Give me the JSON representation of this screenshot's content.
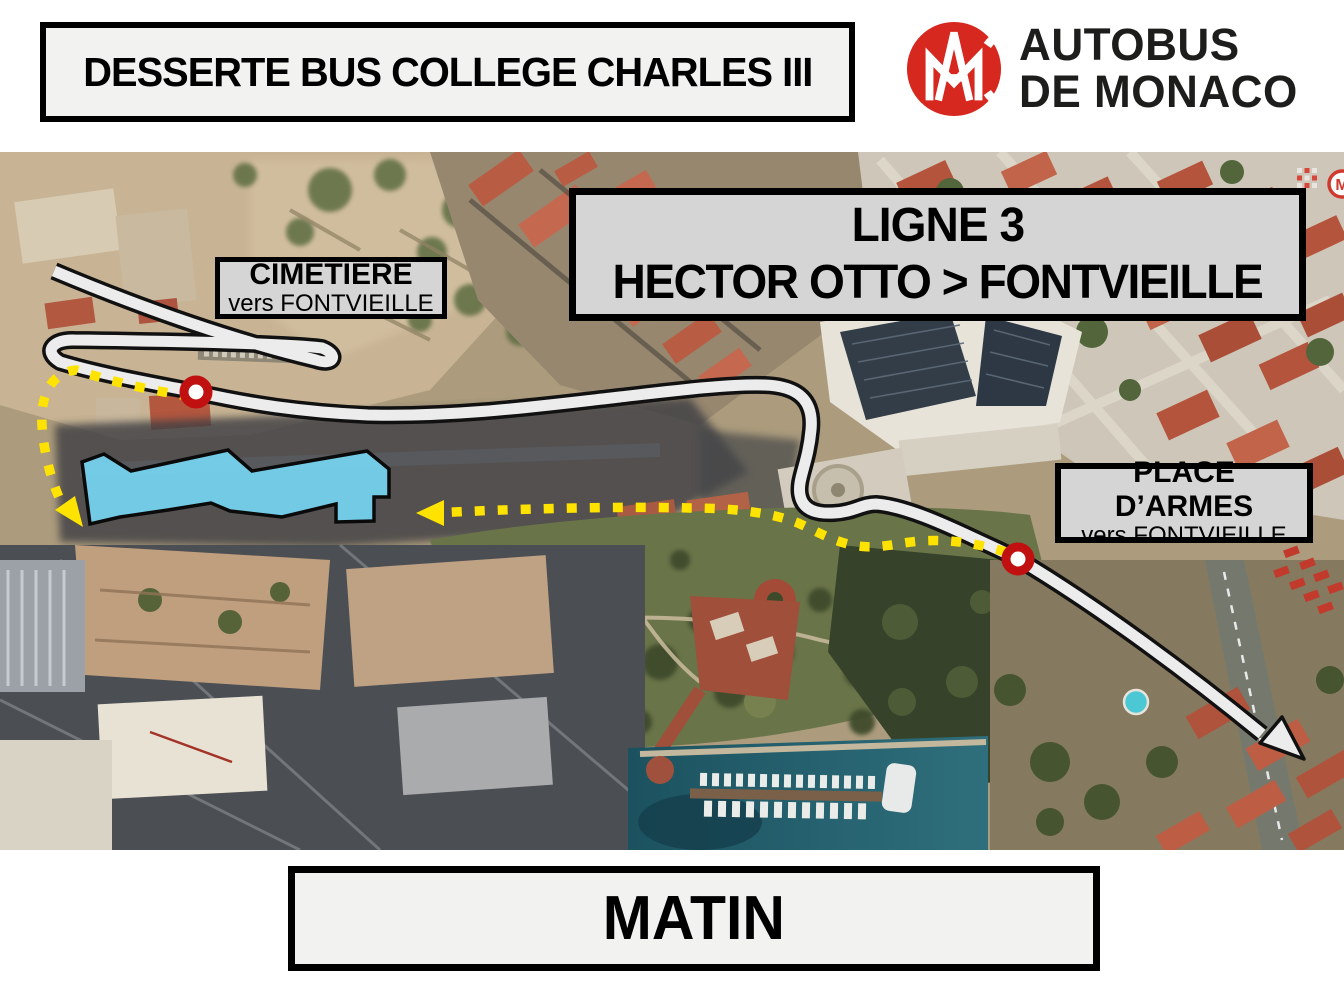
{
  "header": {
    "title": "DESSERTE BUS COLLEGE CHARLES III"
  },
  "logo": {
    "monogram": "CAM",
    "name_line1": "AUTOBUS",
    "name_line2": "DE MONACO",
    "brand_red": "#d7281f",
    "text_color": "#1d1d1b"
  },
  "map": {
    "route_box": {
      "line1": "LIGNE 3",
      "line2": "HECTOR OTTO > FONTVIEILLE"
    },
    "stops": [
      {
        "name": "CIMETIERE",
        "direction": "vers FONTVIEILLE",
        "marker_x": 196,
        "marker_y": 392
      },
      {
        "name": "PLACE D’ARMES",
        "direction": "vers FONTVIEILLE",
        "marker_x": 1018,
        "marker_y": 559
      }
    ],
    "legend": {
      "bus_route_color": "#ececec",
      "walk_path_color": "#ffe300",
      "college_highlight_color": "#76d5f2",
      "stop_marker_color": "#c01010"
    },
    "corner_badge_letter": "M"
  },
  "footer": {
    "label": "MATIN"
  }
}
